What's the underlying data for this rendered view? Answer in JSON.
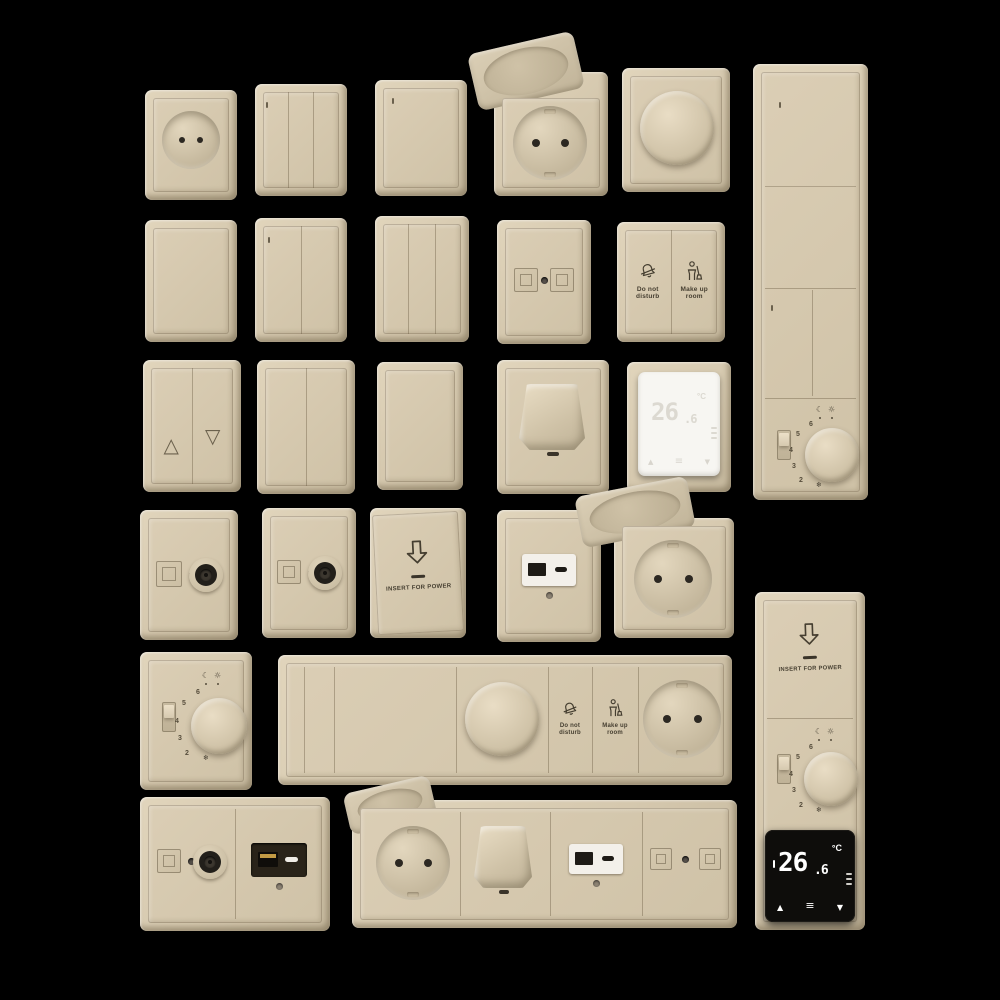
{
  "scene": {
    "background_color": "#000000",
    "plate_color": "#d6c9af",
    "engraving_color": "#453e30",
    "description": "Beige hotel electrical fittings collection: switches, sockets, dimmers, thermostats"
  },
  "labels": {
    "do_not_disturb": "Do not\ndisturb",
    "make_up_room": "Make up\nroom",
    "insert_for_power": "INSERT FOR POWER"
  },
  "icons": {
    "blind_up": "△",
    "blind_down": "▽",
    "frost": "❄",
    "night": "☾",
    "day": "☼",
    "up": "▲",
    "down": "▼",
    "menu": "≡",
    "unit_degree": "°C"
  },
  "thermostat_digital": {
    "value": "26",
    "decimal": ".6",
    "unit": "°C"
  },
  "thermostat_dial": {
    "numbers": [
      "6",
      "5",
      "4",
      "3",
      "2"
    ]
  }
}
